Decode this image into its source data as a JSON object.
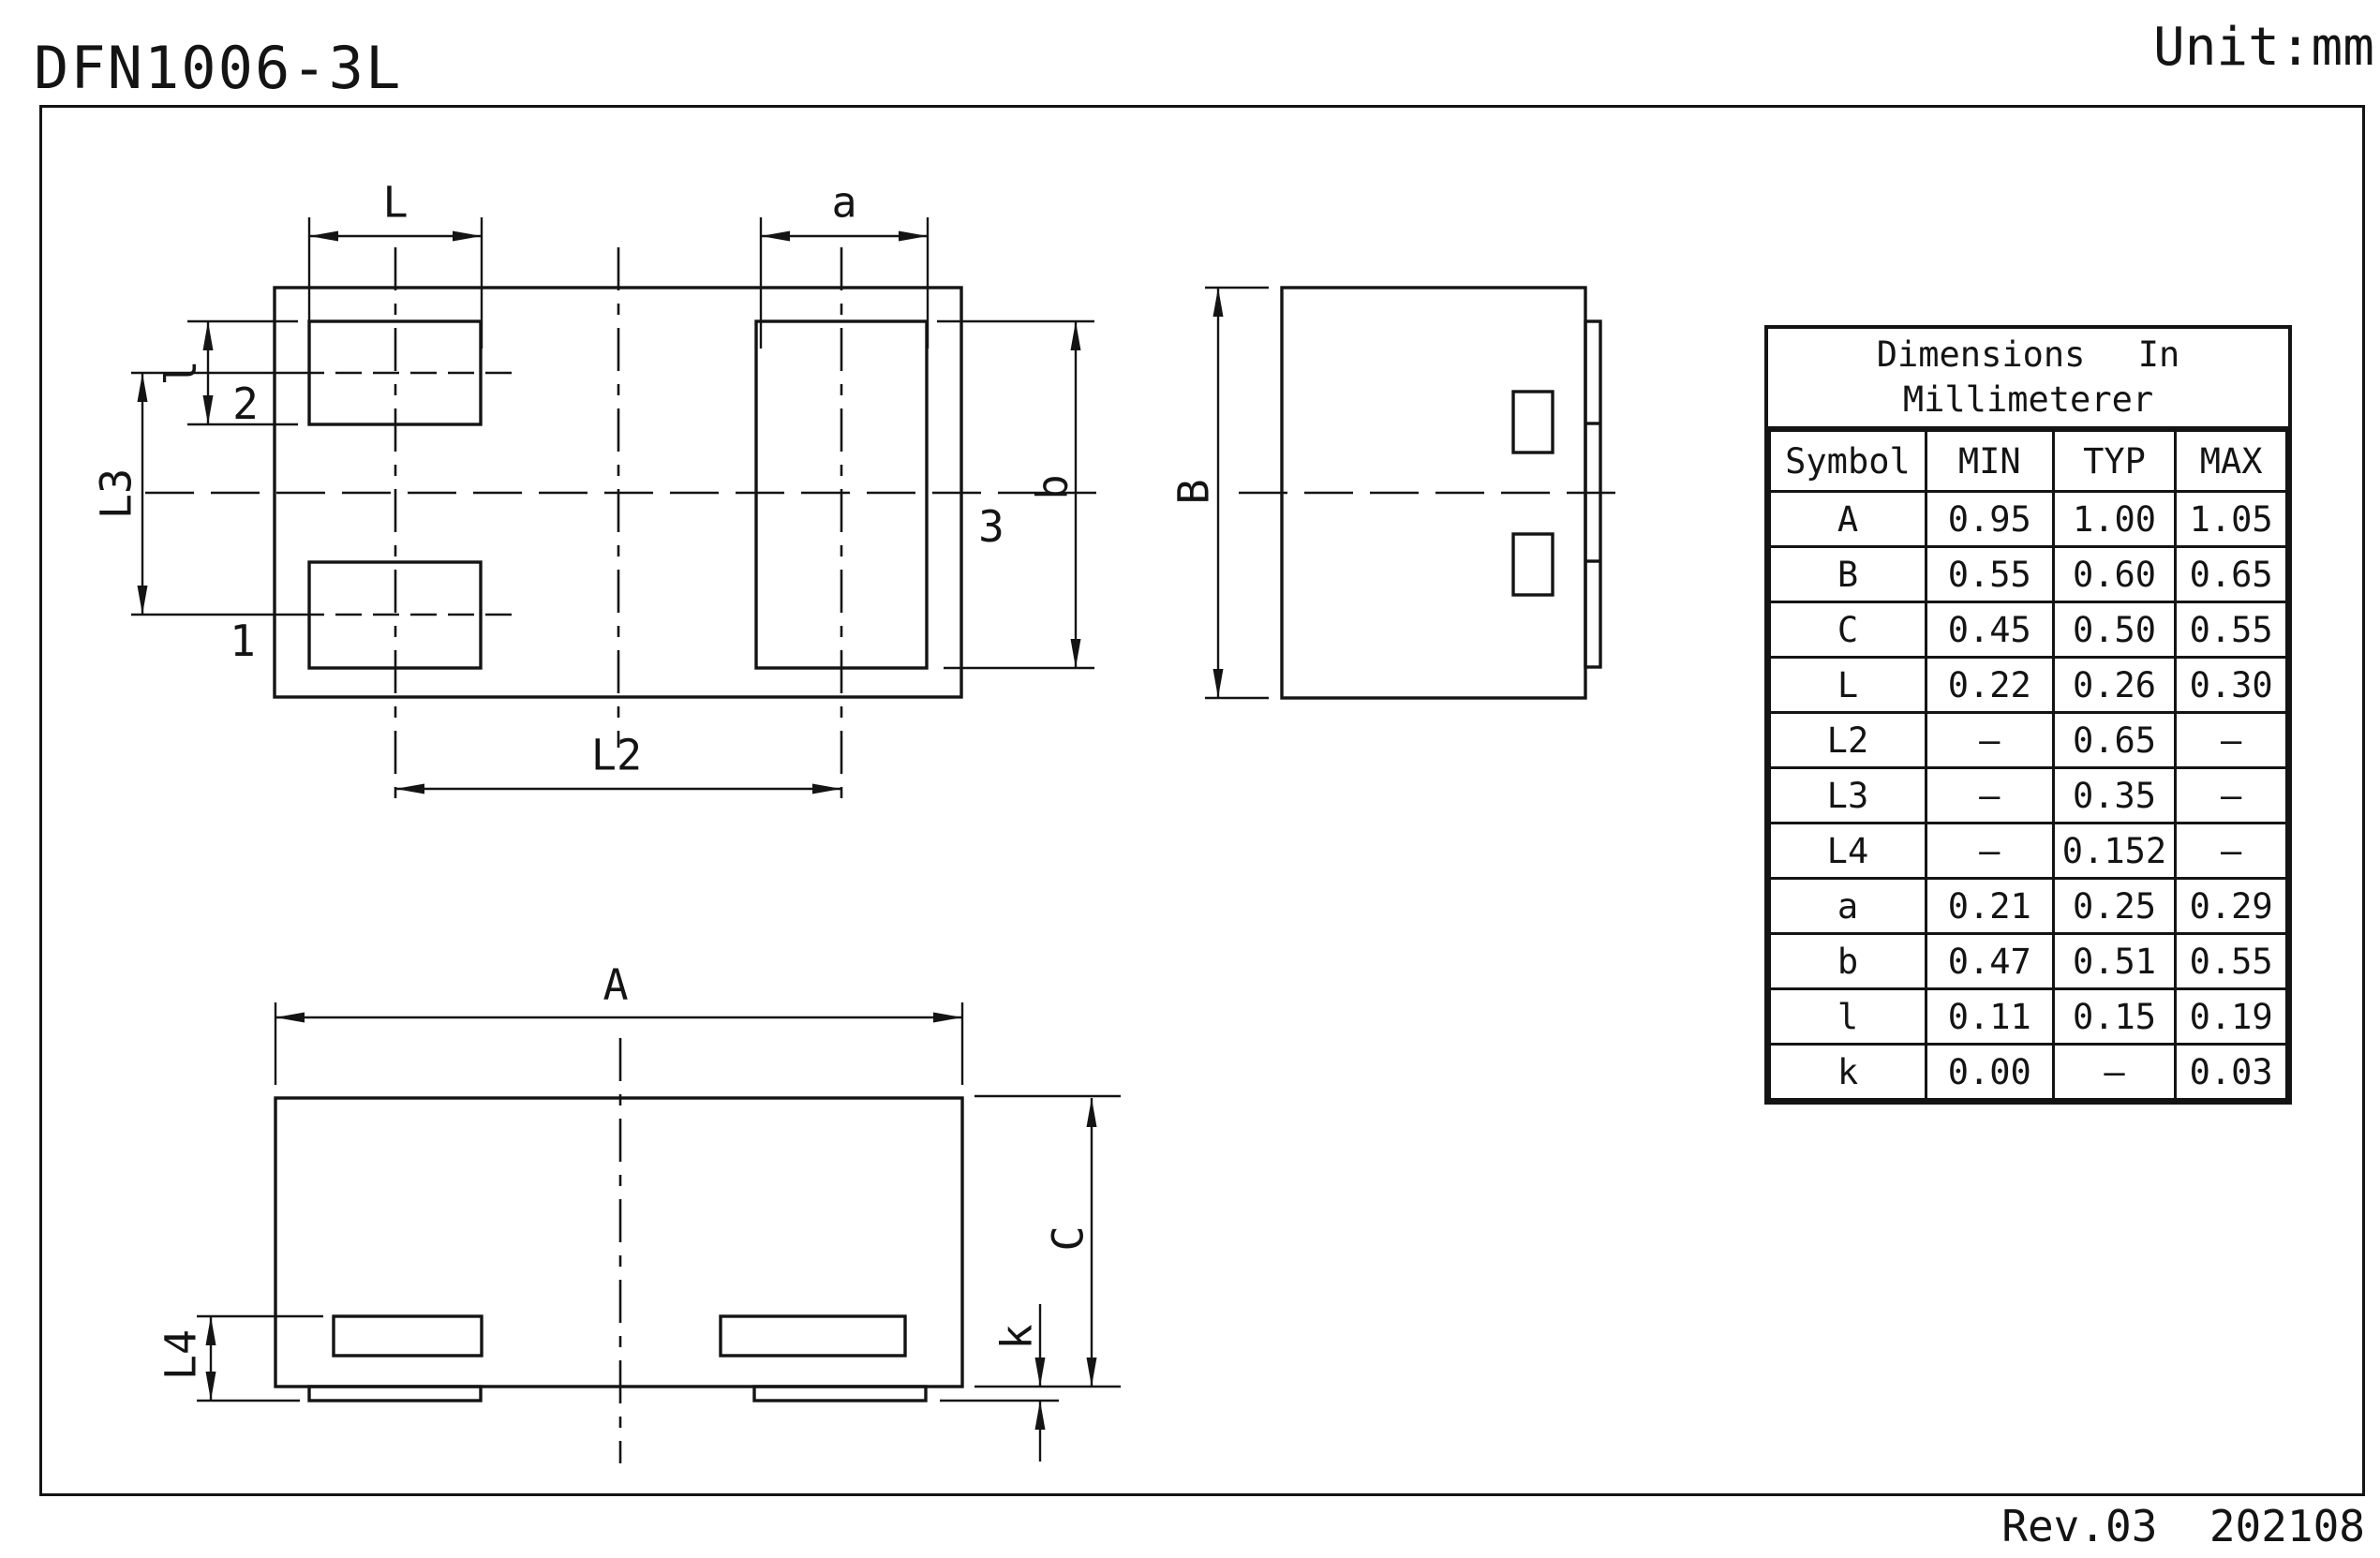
{
  "sheet": {
    "title": "DFN1006-3L",
    "unit": "Unit:mm",
    "revision": "Rev.03  202108"
  },
  "table": {
    "title_line1": "Dimensions In",
    "title_line2": "Millimeterer",
    "headers": [
      "Symbol",
      "MIN",
      "TYP",
      "MAX"
    ],
    "rows": [
      {
        "symbol": "A",
        "min": "0.95",
        "typ": "1.00",
        "max": "1.05"
      },
      {
        "symbol": "B",
        "min": "0.55",
        "typ": "0.60",
        "max": "0.65"
      },
      {
        "symbol": "C",
        "min": "0.45",
        "typ": "0.50",
        "max": "0.55"
      },
      {
        "symbol": "L",
        "min": "0.22",
        "typ": "0.26",
        "max": "0.30"
      },
      {
        "symbol": "L2",
        "min": "–",
        "typ": "0.65",
        "max": "–"
      },
      {
        "symbol": "L3",
        "min": "–",
        "typ": "0.35",
        "max": "–"
      },
      {
        "symbol": "L4",
        "min": "–",
        "typ": "0.152",
        "max": "–"
      },
      {
        "symbol": "a",
        "min": "0.21",
        "typ": "0.25",
        "max": "0.29"
      },
      {
        "symbol": "b",
        "min": "0.47",
        "typ": "0.51",
        "max": "0.55"
      },
      {
        "symbol": "l",
        "min": "0.11",
        "typ": "0.15",
        "max": "0.19"
      },
      {
        "symbol": "k",
        "min": "0.00",
        "typ": "–",
        "max": "0.03"
      }
    ]
  },
  "labels": {
    "top_view": {
      "L": "L",
      "a": "a",
      "l": "l",
      "L3": "L3",
      "b": "b",
      "L2": "L2",
      "pin1": "1",
      "pin2": "2",
      "pin3": "3"
    },
    "side_view": {
      "B": "B"
    },
    "bottom_view": {
      "A": "A",
      "C": "C",
      "L4": "L4",
      "k": "k"
    }
  }
}
